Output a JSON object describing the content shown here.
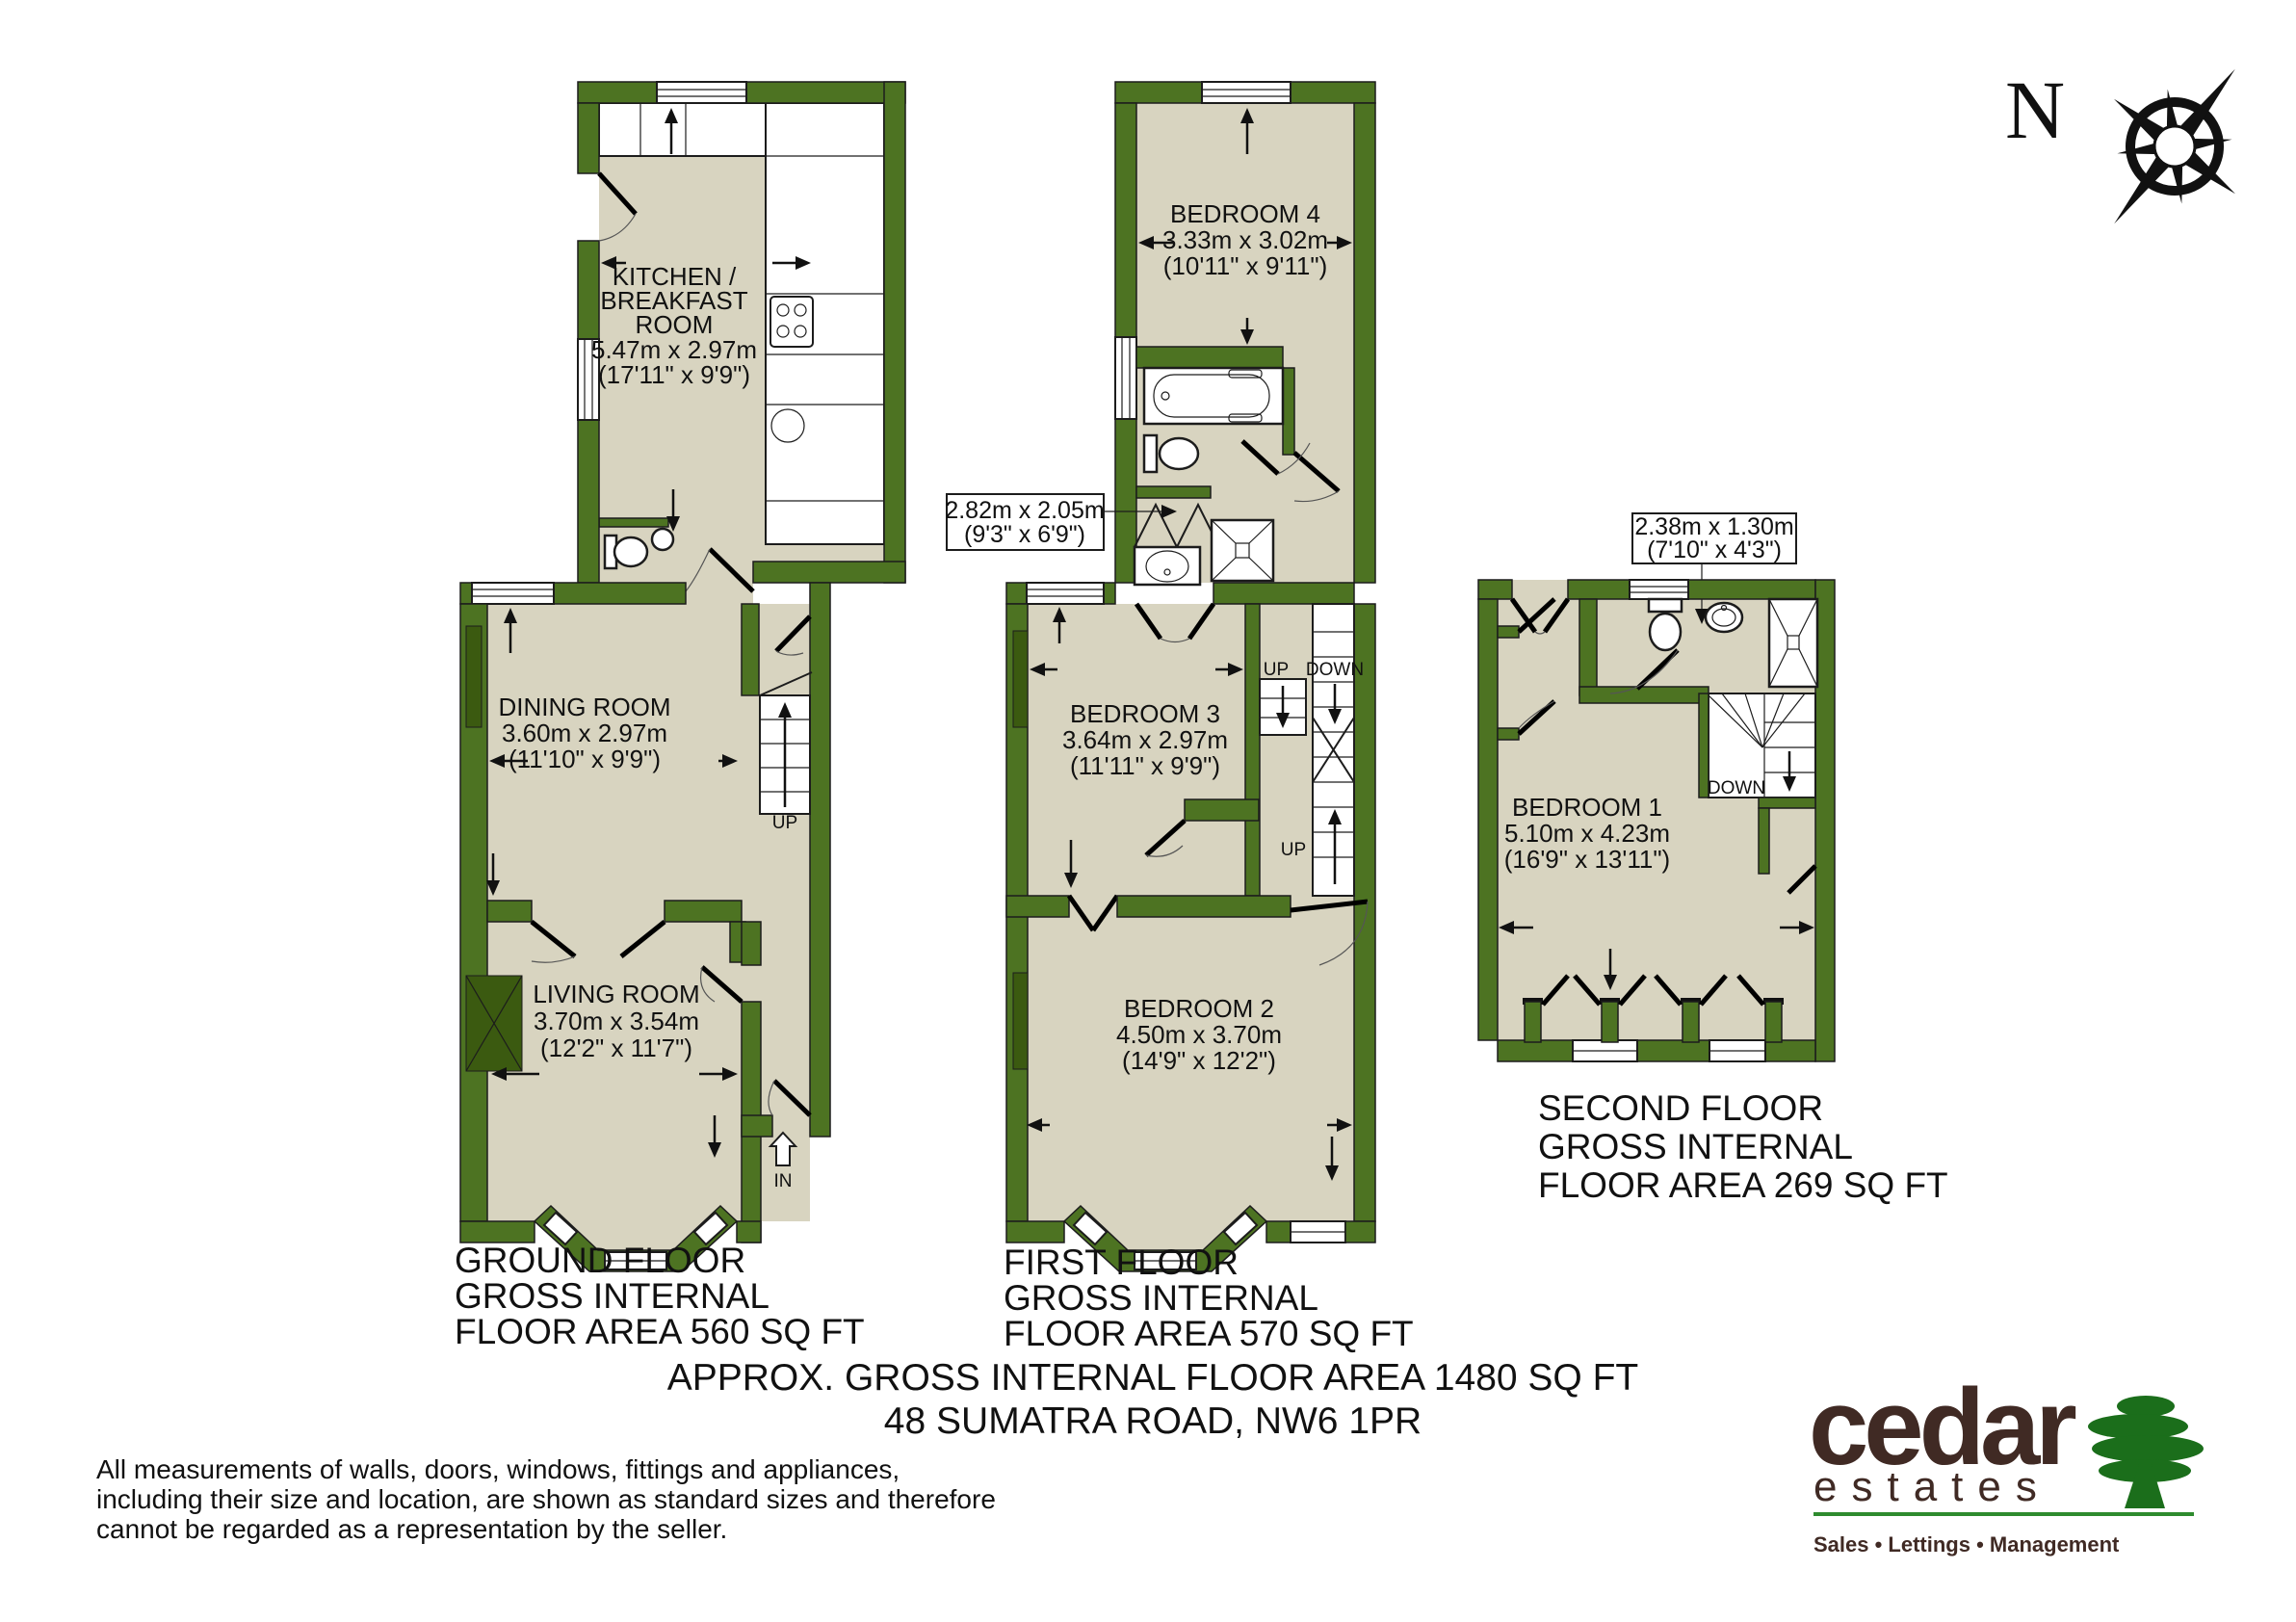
{
  "compass": {
    "north": "N"
  },
  "ground": {
    "kitchen_1": "KITCHEN /",
    "kitchen_2": "BREAKFAST",
    "kitchen_3": "ROOM",
    "kitchen_4": "5.47m x 2.97m",
    "kitchen_5": "(17'11\" x 9'9\")",
    "dining_1": "DINING ROOM",
    "dining_2": "3.60m x 2.97m",
    "dining_3": "(11'10\" x 9'9\")",
    "living_1": "LIVING ROOM",
    "living_2": "3.70m x 3.54m",
    "living_3": "(12'2\" x 11'7\")",
    "up": "UP",
    "entrance": "IN",
    "cap_1": "GROUND FLOOR",
    "cap_2": "GROSS INTERNAL",
    "cap_3": "FLOOR AREA 560 SQ FT"
  },
  "first": {
    "bed4_1": "BEDROOM 4",
    "bed4_2": "3.33m x 3.02m",
    "bed4_3": "(10'11\" x 9'11\")",
    "bath_1": "2.82m x 2.05m",
    "bath_2": "(9'3\" x 6'9\")",
    "bed3_1": "BEDROOM 3",
    "bed3_2": "3.64m x 2.97m",
    "bed3_3": "(11'11\" x 9'9\")",
    "bed2_1": "BEDROOM 2",
    "bed2_2": "4.50m x 3.70m",
    "bed2_3": "(14'9\" x 12'2\")",
    "up": "UP",
    "down": "DOWN",
    "up2": "UP",
    "cap_1": "FIRST FLOOR",
    "cap_2": "GROSS INTERNAL",
    "cap_3": "FLOOR AREA 570 SQ FT"
  },
  "second": {
    "bath_1": "2.38m x 1.30m",
    "bath_2": "(7'10\" x 4'3\")",
    "bed1_1": "BEDROOM 1",
    "bed1_2": "5.10m x 4.23m",
    "bed1_3": "(16'9\" x 13'11\")",
    "down": "DOWN",
    "cap_1": "SECOND FLOOR",
    "cap_2": "GROSS INTERNAL",
    "cap_3": "FLOOR AREA 269 SQ FT"
  },
  "summary": {
    "line1": "APPROX. GROSS INTERNAL FLOOR AREA 1480 SQ FT",
    "line2": "48 SUMATRA ROAD, NW6 1PR"
  },
  "disclaimer": {
    "line1": "All measurements of walls, doors, windows, fittings and appliances,",
    "line2": "including their size and location, are shown as standard sizes and therefore",
    "line3": "cannot be regarded as a representation by the seller."
  },
  "logo": {
    "brand": "cedar",
    "brand2": "estates",
    "tagline": "Sales • Lettings • Management"
  },
  "colors": {
    "wall_green": "#4d7322",
    "floor_beige": "#d8d4c0",
    "logo_brown": "#402a24",
    "tree_green": "#1b6e1b"
  }
}
